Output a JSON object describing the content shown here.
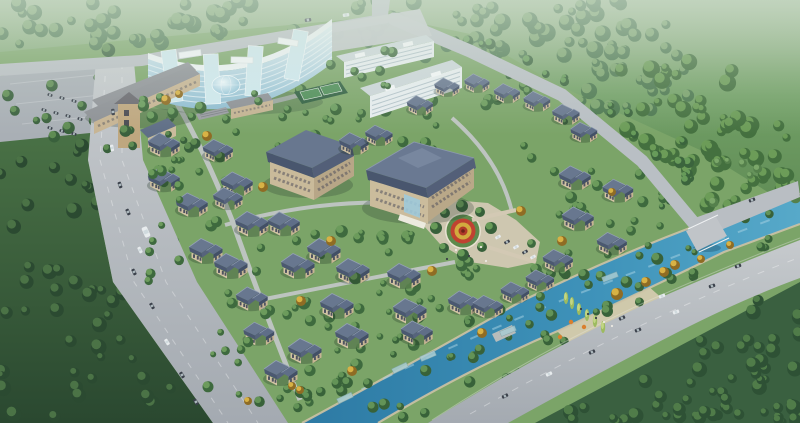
{
  "scene": {
    "image_type": "architectural aerial rendering of a master-planned villa community",
    "text_content": [],
    "landmarks": [
      "curved-glass-highrise",
      "glass-dome-atrium",
      "tan-annex-building",
      "annex-clock-tower",
      "apartment-slab-1",
      "apartment-slab-2",
      "clubhouse-building",
      "west-building",
      "row-building",
      "pergola",
      "sports-courts",
      "central-garden-circle",
      "riverside-plaza",
      "main-boulevard",
      "top-road",
      "ne-boundary-road",
      "canal",
      "canal-bridge",
      "footbridge",
      "se-road",
      "parking-lot",
      "forest"
    ],
    "colors": {
      "forest_dark": "#2b4a31",
      "forest_mid": "#4d7850",
      "forest_light": "#7ca46e",
      "community_lawn": "#7ba468",
      "road": "#b7bcc2",
      "canal_deep": "#2d7aa4",
      "canal_light": "#57a9c9",
      "villa_roof": "#5a6880",
      "villa_wall": "#d3c4a4",
      "glass_blue": "#9fc6d6",
      "garden_red": "#bf4231",
      "garden_yellow": "#d2ab3e",
      "autumn_tree": "#d8b245",
      "sand_bank": "#cdc2a4"
    }
  },
  "tree_colors_note": "clusters: [x,y,w,h,count,rmin,rmax,dark,light,layer]",
  "clusters": [
    [
      0,
      0,
      430,
      46,
      55,
      4,
      9,
      "#4d7850",
      "#7ca46e",
      "u"
    ],
    [
      420,
      0,
      210,
      60,
      40,
      4,
      9,
      "#4d7850",
      "#7ca46e",
      "u"
    ],
    [
      560,
      20,
      130,
      90,
      35,
      4,
      9,
      "#4d7850",
      "#7ca46e",
      "u"
    ],
    [
      620,
      60,
      120,
      110,
      35,
      4,
      9,
      "#44703f",
      "#6f9e5a",
      "u"
    ],
    [
      700,
      100,
      100,
      112,
      30,
      4,
      9,
      "#44703f",
      "#6f9e5a",
      "u"
    ],
    [
      0,
      140,
      122,
      96,
      16,
      4,
      8,
      "#2b4a31",
      "#4d7548",
      "u"
    ],
    [
      0,
      236,
      150,
      96,
      18,
      4,
      8,
      "#2b4a31",
      "#4d7548",
      "u"
    ],
    [
      0,
      332,
      190,
      90,
      20,
      4,
      8,
      "#2b4a31",
      "#4d7548",
      "u"
    ],
    [
      560,
      398,
      240,
      25,
      14,
      4,
      8,
      "#2e5135",
      "#527e4b",
      "u"
    ],
    [
      628,
      368,
      172,
      55,
      16,
      4,
      8,
      "#2e5135",
      "#527e4b",
      "u"
    ],
    [
      698,
      340,
      102,
      83,
      16,
      4,
      8,
      "#2e5135",
      "#527e4b",
      "u"
    ],
    [
      748,
      300,
      52,
      123,
      12,
      4,
      8,
      "#2e5135",
      "#527e4b",
      "u"
    ],
    [
      690,
      148,
      108,
      58,
      8,
      3,
      6,
      "#55804c",
      "#7da96b",
      "u"
    ],
    [
      0,
      50,
      126,
      92,
      12,
      3.5,
      7,
      "#39603c",
      "#618e54",
      "u"
    ],
    [
      135,
      82,
      395,
      70,
      32,
      3,
      6.5,
      "#3e6a3e",
      "#6f9e5e",
      "u"
    ],
    [
      125,
      154,
      238,
      128,
      26,
      3,
      6.5,
      "#3e6a3e",
      "#6f9e5e",
      "u"
    ],
    [
      345,
      222,
      80,
      78,
      12,
      3,
      6.5,
      "#3e6a3e",
      "#6f9e5e",
      "u"
    ],
    [
      428,
      258,
      115,
      42,
      9,
      3,
      6,
      "#3e6a3e",
      "#6f9e5e",
      "u"
    ],
    [
      248,
      298,
      118,
      108,
      22,
      3,
      6.5,
      "#3e6a3e",
      "#6f9e5e",
      "u"
    ],
    [
      362,
      300,
      80,
      46,
      10,
      3,
      6,
      "#3e6a3e",
      "#6f9e5e",
      "u"
    ],
    [
      528,
      158,
      92,
      128,
      16,
      3,
      6.5,
      "#3e6a3e",
      "#6f9e5e",
      "u"
    ],
    [
      604,
      160,
      60,
      76,
      9,
      3,
      6,
      "#3e6a3e",
      "#6f9e5e",
      "u"
    ],
    [
      418,
      26,
      80,
      26,
      6,
      3,
      5.5,
      "#3b643d",
      "#699e5c",
      "u"
    ],
    [
      488,
      58,
      80,
      28,
      6,
      3,
      5.5,
      "#3b643d",
      "#699e5c",
      "u"
    ],
    [
      556,
      92,
      80,
      30,
      6,
      3,
      5.5,
      "#3b643d",
      "#699e5c",
      "u"
    ],
    [
      614,
      130,
      78,
      34,
      6,
      3,
      5.5,
      "#3b643d",
      "#699e5c",
      "u"
    ],
    [
      656,
      170,
      72,
      38,
      6,
      3,
      5.5,
      "#3b643d",
      "#699e5c",
      "u"
    ],
    [
      240,
      390,
      70,
      20,
      6,
      3,
      6,
      "#386239",
      "#659659",
      "o"
    ],
    [
      295,
      372,
      100,
      20,
      7,
      3,
      6,
      "#386239",
      "#659659",
      "o"
    ],
    [
      385,
      340,
      100,
      20,
      7,
      3,
      6,
      "#386239",
      "#659659",
      "u"
    ],
    [
      465,
      306,
      100,
      20,
      7,
      3,
      6,
      "#386239",
      "#659659",
      "u"
    ],
    [
      545,
      272,
      100,
      20,
      7,
      3,
      6,
      "#386239",
      "#659659",
      "u"
    ],
    [
      615,
      243,
      96,
      18,
      6,
      3,
      6,
      "#386239",
      "#659659",
      "u"
    ],
    [
      685,
      214,
      90,
      18,
      6,
      3,
      6,
      "#386239",
      "#659659",
      "u"
    ],
    [
      345,
      402,
      90,
      16,
      5,
      3,
      6,
      "#386239",
      "#659659",
      "u"
    ],
    [
      425,
      368,
      100,
      16,
      6,
      3,
      6,
      "#386239",
      "#659659",
      "u"
    ],
    [
      505,
      334,
      100,
      16,
      6,
      3,
      6,
      "#386239",
      "#659659",
      "u"
    ],
    [
      585,
      298,
      96,
      16,
      6,
      3,
      6,
      "#386239",
      "#659659",
      "u"
    ],
    [
      655,
      266,
      90,
      16,
      5,
      3,
      6,
      "#386239",
      "#659659",
      "u"
    ],
    [
      725,
      238,
      70,
      14,
      4,
      3,
      6,
      "#386239",
      "#659659",
      "u"
    ],
    [
      142,
      92,
      200,
      30,
      15,
      3,
      6,
      "#3c673b",
      "#6fa061",
      "o"
    ],
    [
      330,
      50,
      68,
      46,
      8,
      3,
      5.5,
      "#3c673b",
      "#6fa061",
      "o"
    ],
    [
      84,
      126,
      112,
      24,
      8,
      3,
      6,
      "#39603c",
      "#618e54",
      "o"
    ],
    [
      148,
      140,
      34,
      150,
      12,
      3,
      5.5,
      "#3e6a3e",
      "#6f9e5e",
      "o"
    ],
    [
      196,
      280,
      60,
      120,
      10,
      3,
      5.5,
      "#3e6a3e",
      "#6f9e5e",
      "o"
    ]
  ],
  "villas_note": "[x,y,scale]",
  "villas": [
    [
      420,
      103,
      0.78
    ],
    [
      447,
      85,
      0.75
    ],
    [
      477,
      81,
      0.75
    ],
    [
      507,
      91,
      0.78
    ],
    [
      537,
      99,
      0.8
    ],
    [
      566,
      112,
      0.82
    ],
    [
      584,
      130,
      0.8
    ],
    [
      575,
      175,
      0.95
    ],
    [
      618,
      188,
      0.92
    ],
    [
      578,
      216,
      0.95
    ],
    [
      612,
      241,
      0.9
    ],
    [
      558,
      258,
      0.9
    ],
    [
      540,
      278,
      0.85
    ],
    [
      164,
      142,
      0.95
    ],
    [
      164,
      177,
      0.95
    ],
    [
      192,
      202,
      0.95
    ],
    [
      206,
      248,
      1
    ],
    [
      231,
      263,
      1
    ],
    [
      218,
      148,
      0.9
    ],
    [
      237,
      181,
      0.95
    ],
    [
      252,
      221,
      1
    ],
    [
      284,
      221,
      0.95
    ],
    [
      298,
      263,
      1
    ],
    [
      324,
      248,
      1
    ],
    [
      353,
      268,
      1
    ],
    [
      354,
      141,
      0.88
    ],
    [
      379,
      133,
      0.82
    ],
    [
      404,
      273,
      1
    ],
    [
      228,
      196,
      0.88
    ],
    [
      337,
      303,
      1
    ],
    [
      410,
      308,
      1
    ],
    [
      464,
      300,
      0.95
    ],
    [
      488,
      304,
      0.9
    ],
    [
      515,
      290,
      0.85
    ],
    [
      352,
      333,
      1
    ],
    [
      417,
      330,
      0.95
    ],
    [
      305,
      348,
      1
    ],
    [
      281,
      370,
      1
    ],
    [
      252,
      296,
      0.95
    ],
    [
      259,
      331,
      0.92
    ]
  ],
  "cars_note": "[x,y,rot,colorIdx,scale?]",
  "car_colors": [
    "#3b414b",
    "#e8ecee"
  ],
  "cars": [
    [
      113,
      112,
      84,
      0
    ],
    [
      112,
      148,
      80,
      1
    ],
    [
      120,
      185,
      70,
      0
    ],
    [
      128,
      212,
      66,
      0
    ],
    [
      140,
      250,
      64,
      1
    ],
    [
      134,
      272,
      64,
      0
    ],
    [
      152,
      306,
      60,
      0
    ],
    [
      167,
      342,
      58,
      1
    ],
    [
      182,
      375,
      58,
      0
    ],
    [
      196,
      402,
      57,
      0
    ],
    [
      146,
      232,
      66,
      1,
      1.5
    ],
    [
      505,
      396,
      -26,
      0
    ],
    [
      549,
      374,
      -25,
      1
    ],
    [
      592,
      352,
      -24,
      0
    ],
    [
      638,
      330,
      -22,
      0
    ],
    [
      676,
      312,
      -20,
      1
    ],
    [
      622,
      318,
      -24,
      0
    ],
    [
      662,
      296,
      -21,
      1
    ],
    [
      712,
      286,
      -19,
      0
    ],
    [
      738,
      266,
      -18,
      0
    ],
    [
      498,
      237,
      -28,
      1,
      0.8
    ],
    [
      507,
      242,
      -28,
      0,
      0.8
    ],
    [
      516,
      247,
      -28,
      1,
      0.8
    ],
    [
      525,
      252,
      -28,
      0,
      0.8
    ],
    [
      533,
      257,
      -28,
      1,
      0.8
    ],
    [
      50,
      95,
      18,
      0,
      0.7
    ],
    [
      62,
      98,
      18,
      0,
      0.7
    ],
    [
      74,
      101,
      18,
      0,
      0.7
    ],
    [
      44,
      110,
      18,
      0,
      0.7
    ],
    [
      56,
      113,
      18,
      0,
      0.7
    ],
    [
      68,
      116,
      18,
      0,
      0.7
    ],
    [
      80,
      119,
      18,
      0,
      0.7
    ],
    [
      50,
      128,
      18,
      0,
      0.7
    ],
    [
      62,
      131,
      18,
      0,
      0.7
    ],
    [
      74,
      134,
      18,
      0,
      0.7
    ],
    [
      308,
      20,
      -8,
      0
    ],
    [
      346,
      15,
      -8,
      1
    ],
    [
      752,
      200,
      -21,
      0
    ]
  ],
  "people_colors": [
    "#3a3f46",
    "#ece9e2"
  ],
  "people": [
    [
      456,
      250,
      1
    ],
    [
      469,
      256,
      0
    ],
    [
      481,
      247,
      1
    ],
    [
      447,
      259,
      0
    ],
    [
      486,
      261,
      1
    ],
    [
      596,
      318,
      0
    ],
    [
      604,
      322,
      1
    ],
    [
      588,
      314,
      0
    ],
    [
      612,
      326,
      1
    ],
    [
      581,
      309,
      0
    ]
  ],
  "poplars": [
    [
      572,
      303
    ],
    [
      579,
      309
    ],
    [
      587,
      315
    ],
    [
      595,
      321
    ],
    [
      603,
      327
    ],
    [
      566,
      298
    ]
  ],
  "docks": [
    [
      345,
      398,
      -25
    ],
    [
      400,
      368,
      -25
    ],
    [
      428,
      356,
      -23
    ],
    [
      508,
      331,
      -22
    ],
    [
      610,
      277,
      -21
    ]
  ],
  "orange_features": [
    [
      584,
      327
    ],
    [
      571,
      322
    ],
    [
      560,
      337
    ]
  ],
  "accents_yellow_note": "[x,y,r] autumn trees",
  "accents_yellow": [
    [
      166,
      100,
      5
    ],
    [
      179,
      94,
      4
    ],
    [
      207,
      136,
      5
    ],
    [
      263,
      187,
      5
    ],
    [
      331,
      241,
      5
    ],
    [
      301,
      301,
      5
    ],
    [
      432,
      271,
      5
    ],
    [
      521,
      211,
      5
    ],
    [
      562,
      241,
      5
    ],
    [
      612,
      192,
      4
    ],
    [
      352,
      371,
      5
    ],
    [
      482,
      333,
      5
    ],
    [
      300,
      390,
      4
    ],
    [
      617,
      294,
      6
    ],
    [
      646,
      282,
      5
    ],
    [
      664,
      272,
      5
    ],
    [
      701,
      259,
      4
    ],
    [
      730,
      245,
      4
    ],
    [
      248,
      401,
      4
    ],
    [
      292,
      386,
      4
    ],
    [
      675,
      265,
      5
    ]
  ],
  "accents_green": [
    [
      436,
      228,
      6
    ],
    [
      445,
      213,
      5
    ],
    [
      462,
      206,
      6
    ],
    [
      480,
      212,
      5
    ],
    [
      491,
      228,
      6
    ],
    [
      482,
      247,
      5
    ],
    [
      463,
      255,
      6
    ],
    [
      444,
      248,
      5
    ]
  ],
  "garden_circle": {
    "cx": 463,
    "cy": 231,
    "rings": [
      {
        "r": 16.5,
        "fill": "#5d8a4c"
      },
      {
        "r": 12.5,
        "fill": "#bf4231"
      },
      {
        "r": 8.5,
        "fill": "#d2ab3e"
      },
      {
        "r": 4.5,
        "fill": "#b03a29"
      },
      {
        "r": 1.8,
        "fill": "#6e2418"
      }
    ]
  }
}
